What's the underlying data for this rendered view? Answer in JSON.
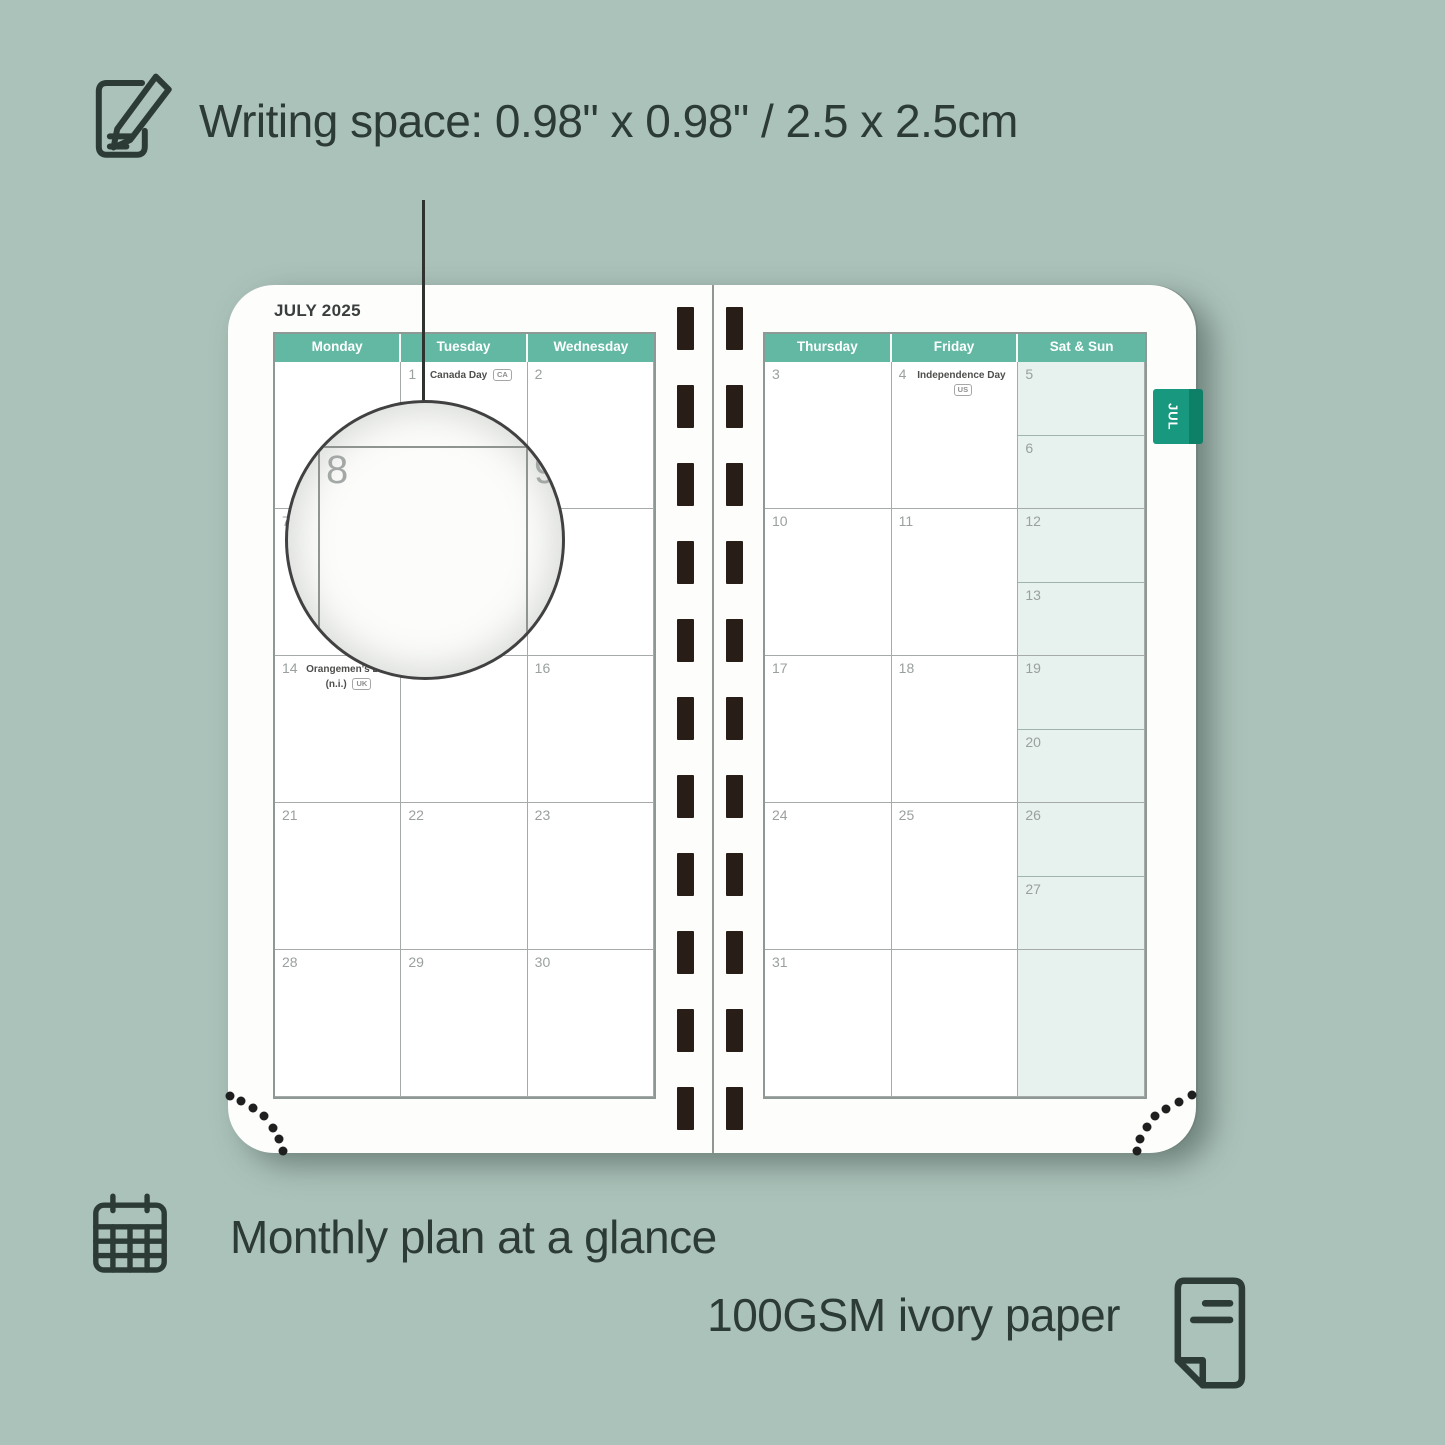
{
  "colors": {
    "background": "#abc2ba",
    "header_teal": "#62b8a3",
    "tab_teal": "#18997f",
    "weekend_fill": "#e7f1ed",
    "ink": "#2c3b36",
    "binding": "#291d18"
  },
  "top_callout": {
    "label": "Writing space: 0.98\" x 0.98\" / 2.5 x 2.5cm",
    "icon": "pencil-note-icon"
  },
  "planner": {
    "month_title": "JULY 2025",
    "month_tab": "JUL",
    "left_page": {
      "day_headers": [
        "Monday",
        "Tuesday",
        "Wednesday"
      ],
      "weeks": [
        [
          {
            "day": ""
          },
          {
            "day": "1",
            "holiday": "Canada Day",
            "region": "CA"
          },
          {
            "day": "2"
          }
        ],
        [
          {
            "day": "7"
          },
          {
            "day": "8"
          },
          {
            "day": "9"
          }
        ],
        [
          {
            "day": "14",
            "holiday": "Orangemen's Day (n.i.)",
            "region": "UK"
          },
          {
            "day": "15"
          },
          {
            "day": "16"
          }
        ],
        [
          {
            "day": "21"
          },
          {
            "day": "22"
          },
          {
            "day": "23"
          }
        ],
        [
          {
            "day": "28"
          },
          {
            "day": "29"
          },
          {
            "day": "30"
          }
        ]
      ]
    },
    "right_page": {
      "day_headers": [
        "Thursday",
        "Friday",
        "Sat & Sun"
      ],
      "weeks": [
        [
          {
            "day": "3"
          },
          {
            "day": "4",
            "holiday": "Independence Day",
            "region": "US"
          },
          {
            "weekend": true,
            "sat": "5",
            "sun": "6"
          }
        ],
        [
          {
            "day": "10"
          },
          {
            "day": "11"
          },
          {
            "weekend": true,
            "sat": "12",
            "sun": "13"
          }
        ],
        [
          {
            "day": "17"
          },
          {
            "day": "18"
          },
          {
            "weekend": true,
            "sat": "19",
            "sun": "20"
          }
        ],
        [
          {
            "day": "24"
          },
          {
            "day": "25"
          },
          {
            "weekend": true,
            "sat": "26",
            "sun": "27"
          }
        ],
        [
          {
            "day": "31"
          },
          {
            "day": ""
          },
          {
            "weekend": true,
            "single": true,
            "sat": ""
          }
        ]
      ]
    }
  },
  "magnifier": {
    "cell_day": "8",
    "adjacent_day": "9"
  },
  "features": {
    "monthly": {
      "label": "Monthly plan at a glance",
      "icon": "calendar-grid-icon"
    },
    "paper": {
      "label": "100GSM ivory paper",
      "icon": "paper-icon"
    }
  }
}
